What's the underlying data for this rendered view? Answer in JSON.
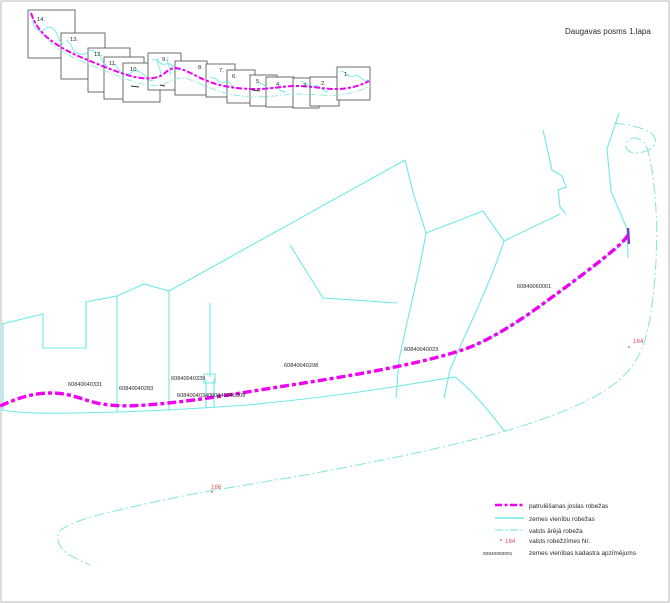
{
  "title": "Daugavas posms 1.lapa",
  "index_map": {
    "tiles": [
      "14.",
      "13.",
      "12.",
      "11.",
      "10.",
      "9.",
      "8.",
      "7.",
      "6.",
      "5.",
      "4.",
      "3.",
      "2.",
      "1."
    ]
  },
  "map": {
    "parcels": {
      "p331": "60840040331",
      "p283": "60840040283",
      "p339": "60840040339",
      "p340": "60840040340",
      "p309": "60840040309",
      "p298": "60840040298",
      "p023": "60840040023",
      "p60001": "60840060001"
    },
    "border_marks": {
      "m164": "164",
      "m166": "166"
    }
  },
  "legend": {
    "items": [
      {
        "label": "patrulēšanas joslas robežas"
      },
      {
        "label": "zemes vienību robežas"
      },
      {
        "label": "valsts ārējā robeža"
      },
      {
        "label": "valsts robežzīmes Nr.",
        "sample_text": "164"
      },
      {
        "label": "zemes vienības kadastra apzīmējums",
        "sample_text": "60840050001"
      }
    ]
  },
  "colors": {
    "patrol_line": "#f000f0",
    "parcel_line": "#70e8e8",
    "state_border_line": "#8ce8d8",
    "border_mark": "#e25563"
  }
}
